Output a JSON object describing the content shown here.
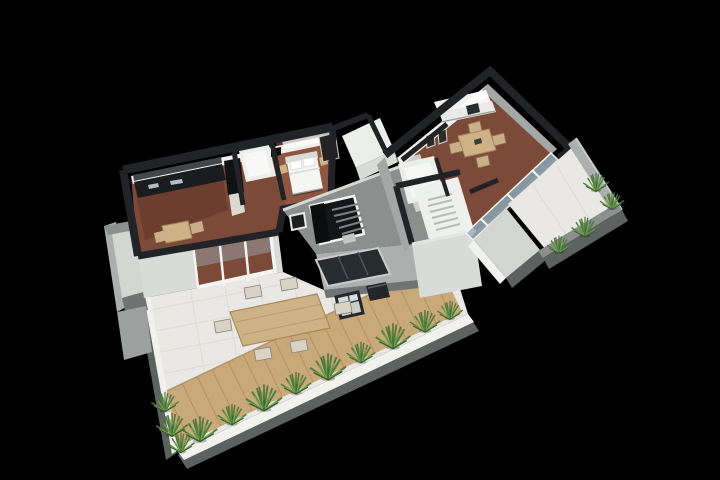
{
  "meta": {
    "description": "3D isometric cutaway floor-plan render of an apartment storey with two units, a central stairwell, an east balcony and a large south terrace, on a black background"
  },
  "palette": {
    "background": "#000000",
    "wall_top": "#212326",
    "wall_inner": "#f0efec",
    "wall_face": "#d9dbd8",
    "wall_face_shade": "#a3a7a5",
    "glow": "#ffffff",
    "concrete_top": "#8b908e",
    "concrete_face": "#abb0ae",
    "concrete_dark": "#6f7472",
    "fascia": "#5d6260",
    "tile": "#e9e8e4",
    "tile_line": "#d6d4ce",
    "deck": "#c9a87a",
    "deck_line": "#a98a5c",
    "planter": "#f1f1ed",
    "plant": "#4f7c3a",
    "plant_light": "#74a455",
    "plant_dark": "#395c2a",
    "terracotta": "#7c4a38",
    "terracotta_light": "#9a6148",
    "terracotta_dark": "#5b3226",
    "bath": "#eceeea",
    "hall": "#ddd8d0",
    "counter": "#1a1c1e",
    "backsplash": "#43474a",
    "fridge": "#101214",
    "wood": "#cdb285",
    "chair": "#c9b088",
    "chair_light": "#d9d3c6",
    "glass": "#9fb2bb",
    "glass_light": "#ccd9de",
    "frame": "#f4f4f2",
    "bed": "#f5f5f3",
    "bed_shadow": "#d9d9d5",
    "dark_furniture": "#232527",
    "stair": "#b9bcb9",
    "opening": "#141517",
    "skylight_glass": "#272c2f",
    "step_line": "#7d8280",
    "walkway": "#d2d5d1"
  },
  "scene": {
    "view": "isometric-cutaway",
    "units": [
      {
        "id": "left-unit",
        "rooms": [
          "kitchen",
          "dining-area",
          "bathroom",
          "bedroom",
          "living-room"
        ],
        "exterior": [
          "west-balcony",
          "south-terrace"
        ]
      },
      {
        "id": "right-unit",
        "rooms": [
          "kitchen",
          "dining-room",
          "hallway",
          "bathroom",
          "stair-room"
        ],
        "exterior": [
          "east-balcony"
        ]
      }
    ],
    "shared": [
      "central-stairwell"
    ],
    "terrace": {
      "surfaces": [
        "white-tile",
        "wood-deck"
      ],
      "objects": [
        "outdoor-dining-table",
        "outdoor-chairs",
        "glass-coffee-table",
        "lounge-seat",
        "skylight",
        "planter-plants"
      ]
    }
  }
}
